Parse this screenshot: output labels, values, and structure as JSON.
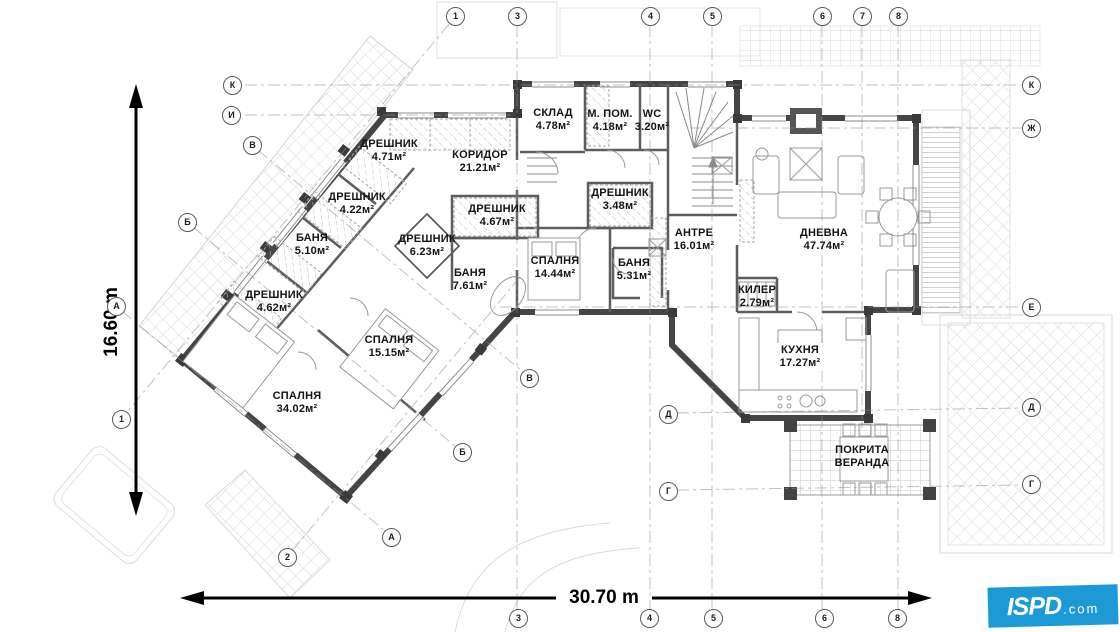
{
  "drawing": {
    "type": "architectural floor plan",
    "language": "Bulgarian"
  },
  "rooms": [
    {
      "name": "СКЛАД",
      "area": "4.78м²"
    },
    {
      "name": "М. ПОМ.",
      "area": "4.18м²"
    },
    {
      "name": "WC",
      "area": "3.20м²"
    },
    {
      "name": "КОРИДОР",
      "area": "21.21м²"
    },
    {
      "name": "ДРЕШНИК",
      "area": "4.71м²"
    },
    {
      "name": "ДРЕШНИК",
      "area": "4.22м²"
    },
    {
      "name": "ДРЕШНИК",
      "area": "4.67м²"
    },
    {
      "name": "ДРЕШНИК",
      "area": "6.23м²"
    },
    {
      "name": "БАНЯ",
      "area": "5.10м²"
    },
    {
      "name": "ДРЕШНИК",
      "area": "4.62м²"
    },
    {
      "name": "БАНЯ",
      "area": "7.61м²"
    },
    {
      "name": "СПАЛНЯ",
      "area": "14.44м²"
    },
    {
      "name": "ДРЕШНИК",
      "area": "3.48м²"
    },
    {
      "name": "БАНЯ",
      "area": "5.31м²"
    },
    {
      "name": "АНТРЕ",
      "area": "16.01м²"
    },
    {
      "name": "ДНЕВНА",
      "area": "47.74м²"
    },
    {
      "name": "КИЛЕР",
      "area": "2.79м²"
    },
    {
      "name": "СПАЛНЯ",
      "area": "15.15м²"
    },
    {
      "name": "СПАЛНЯ",
      "area": "34.02м²"
    },
    {
      "name": "КУХНЯ",
      "area": "17.27м²"
    },
    {
      "name": "ПОКРИТА ВЕРАНДА",
      "area": ""
    }
  ],
  "grid_bubbles": [
    {
      "label": "1"
    },
    {
      "label": "3"
    },
    {
      "label": "4"
    },
    {
      "label": "5"
    },
    {
      "label": "6"
    },
    {
      "label": "7"
    },
    {
      "label": "8"
    },
    {
      "label": "3"
    },
    {
      "label": "4"
    },
    {
      "label": "5"
    },
    {
      "label": "6"
    },
    {
      "label": "8"
    },
    {
      "label": "2"
    },
    {
      "label": "К"
    },
    {
      "label": "И"
    },
    {
      "label": "В"
    },
    {
      "label": "Б"
    },
    {
      "label": "А"
    },
    {
      "label": "1"
    },
    {
      "label": "А"
    },
    {
      "label": "Б"
    },
    {
      "label": "В"
    },
    {
      "label": "К"
    },
    {
      "label": "Ж"
    },
    {
      "label": "Е"
    },
    {
      "label": "Д"
    },
    {
      "label": "Г"
    },
    {
      "label": "Д"
    },
    {
      "label": "Г"
    }
  ],
  "dimensions": {
    "horizontal": "30.70 m",
    "vertical": "16.60 m"
  },
  "logo": {
    "name": "ISPD",
    "tld": ".com",
    "color": "#1b9ad6"
  }
}
